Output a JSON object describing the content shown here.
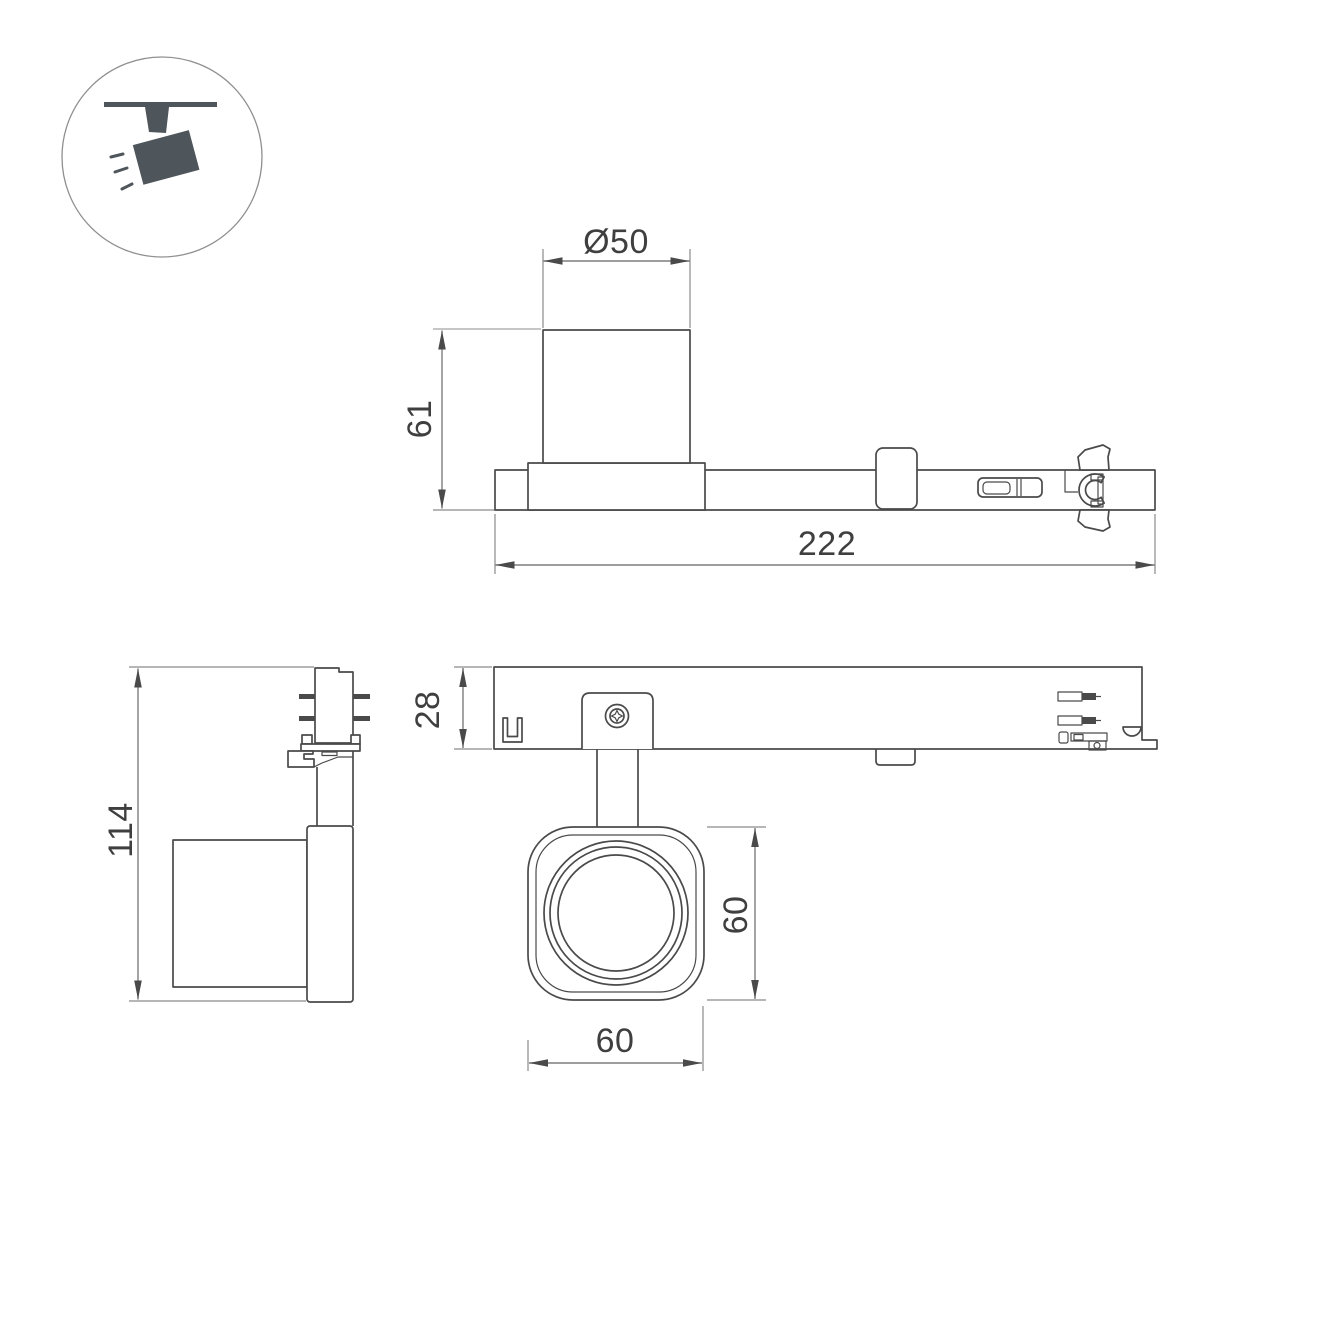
{
  "meta": {
    "background_color": "#ffffff",
    "outline_color": "#4a4a4a",
    "dimension_line_color": "#7d7d7d",
    "icon_color": "#4e555b"
  },
  "icon": {
    "name": "ceiling-track-spotlight-pictogram"
  },
  "views": {
    "side_view": {
      "dims": {
        "diameter": "Ø50",
        "head_height": "61",
        "length": "222"
      }
    },
    "front_view": {
      "dims": {
        "total_height": "114"
      }
    },
    "top_view": {
      "dims": {
        "body_width": "28",
        "head_size_vertical": "60",
        "head_size_horizontal": "60"
      }
    }
  }
}
